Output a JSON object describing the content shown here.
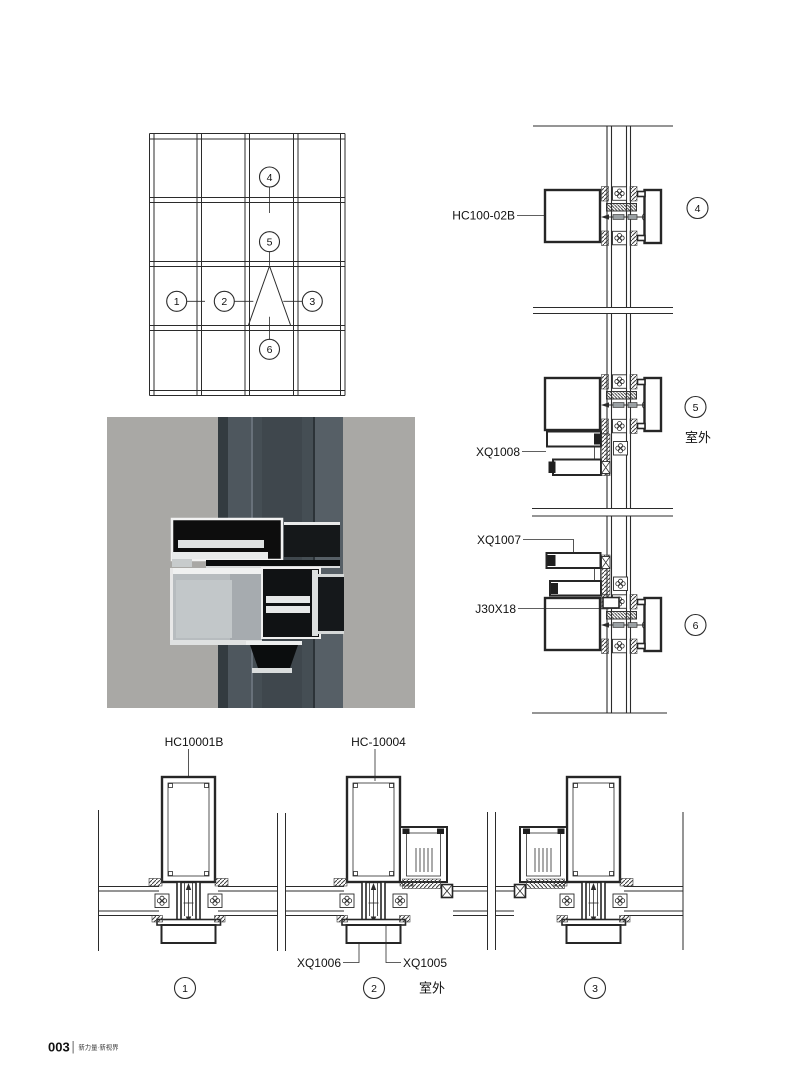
{
  "drawing": {
    "elevation": {
      "callout_1": "1",
      "callout_2": "2",
      "callout_3": "3",
      "callout_4": "4",
      "callout_5": "5",
      "callout_6": "6"
    },
    "vertical_details": {
      "label_mullion": "HC100-02B",
      "label_vent_upper": "XQ1008",
      "label_vent_lower": "XQ1007",
      "label_connector": "J30X18",
      "callout_top": "4",
      "callout_mid": "5",
      "callout_bottom": "6",
      "outdoor": "室外"
    },
    "plan_details": {
      "label_mullion_1": "HC10001B",
      "label_mullion_2": "HC-10004",
      "label_cover": "XQ1006",
      "label_insert": "XQ1005",
      "callout_left": "1",
      "callout_center": "2",
      "callout_right": "3",
      "outdoor": "室外"
    }
  },
  "colors": {
    "line": "#2b2b2b",
    "photo_background": "#a9a8a5",
    "photo_profile_dark": "#475057"
  },
  "footer": {
    "page_number": "003",
    "tagline": "新力量·新视界"
  }
}
